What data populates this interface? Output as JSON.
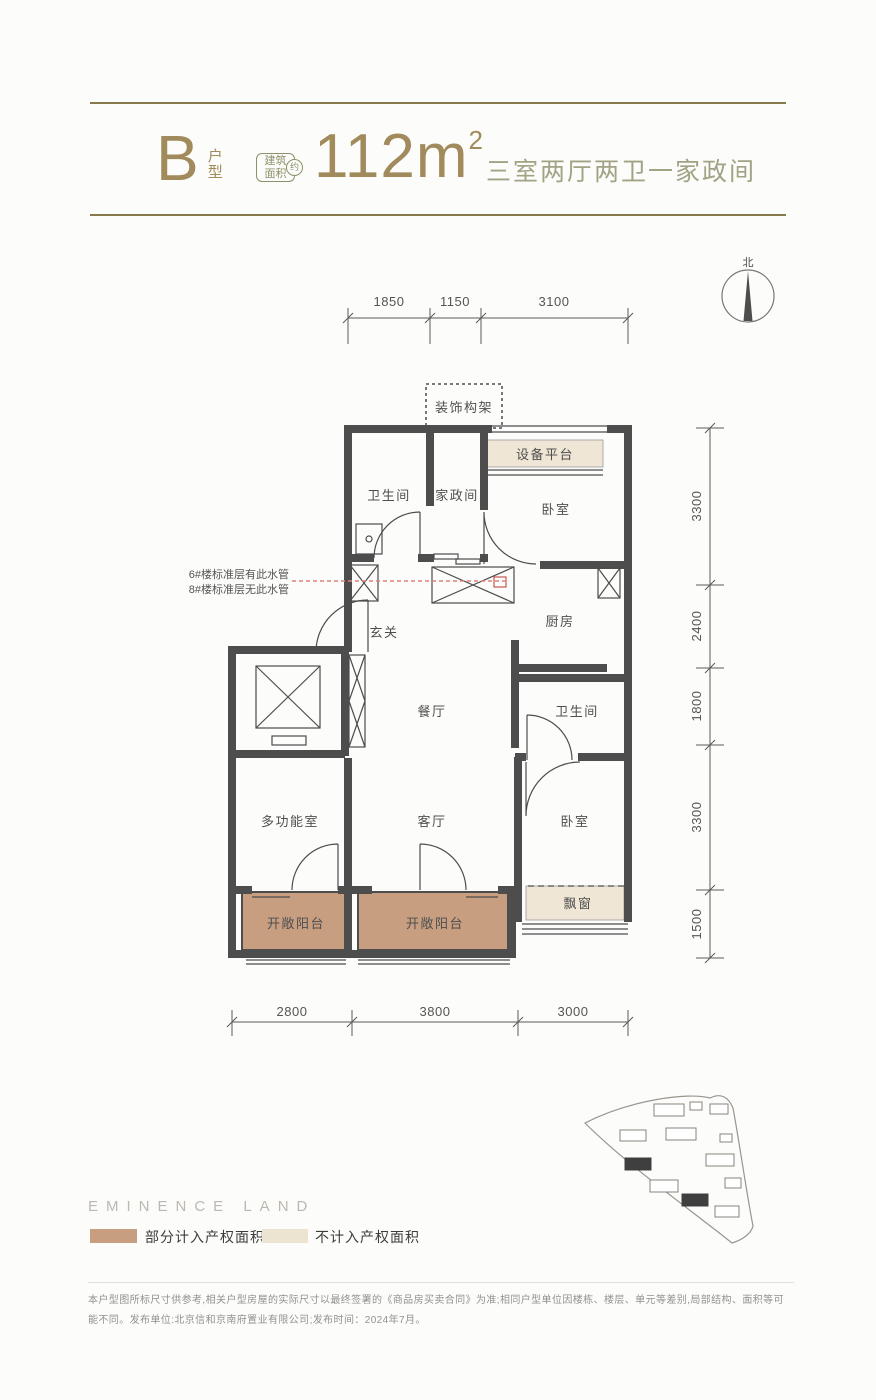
{
  "header": {
    "unit": "B",
    "unit_type": "户型",
    "badge_line1": "建筑",
    "badge_line2": "面积",
    "badge_approx": "约",
    "area": "112m",
    "area_sup": "2",
    "summary": "三室两厅两卫一家政间"
  },
  "compass": {
    "north": "北"
  },
  "plan": {
    "labels": {
      "decor_frame": "装饰构架",
      "equip_platform": "设备平台",
      "bath_top": "卫生间",
      "housekeeping": "家政间",
      "bedroom_top": "卧室",
      "kitchen": "厨房",
      "foyer": "玄关",
      "dining": "餐厅",
      "bath_right": "卫生间",
      "multi_room": "多功能室",
      "living": "客厅",
      "bedroom_bottom": "卧室",
      "balcony_left": "开敞阳台",
      "balcony_center": "开敞阳台",
      "bay_window": "飘窗"
    },
    "pipe_note": {
      "line1": "6#楼标准层有此水管",
      "line2": "8#楼标准层无此水管"
    },
    "dims": {
      "top": [
        "1850",
        "1150",
        "3100"
      ],
      "right": [
        "3300",
        "2400",
        "1800",
        "3300",
        "1500"
      ],
      "bottom": [
        "2800",
        "3800",
        "3000"
      ]
    }
  },
  "footer": {
    "brand": "EMINENCE LAND",
    "legend": [
      {
        "label": "部分计入产权面积",
        "color": "#c79e80"
      },
      {
        "label": "不计入产权面积",
        "color": "#ece3d1"
      }
    ],
    "disclaimer": "本户型图所标尺寸供参考,相关户型房屋的实际尺寸以最终签署的《商品房买卖合同》为准;相同户型单位因楼栋、楼层、单元等差别,局部结构、面积等可能不同。发布单位:北京信和京南府置业有限公司;发布时间：2024年7月。"
  },
  "colors": {
    "accent_bronze": "#a18b5c",
    "accent_olive_line": "#897a4e",
    "badge_olive": "#8d9069",
    "summary_sage": "#a2a285",
    "wall": "#4d4d4d",
    "balcony_fill": "#c79e80",
    "noncount_fill": "#efe6d5",
    "pipe_red": "#e08080"
  }
}
